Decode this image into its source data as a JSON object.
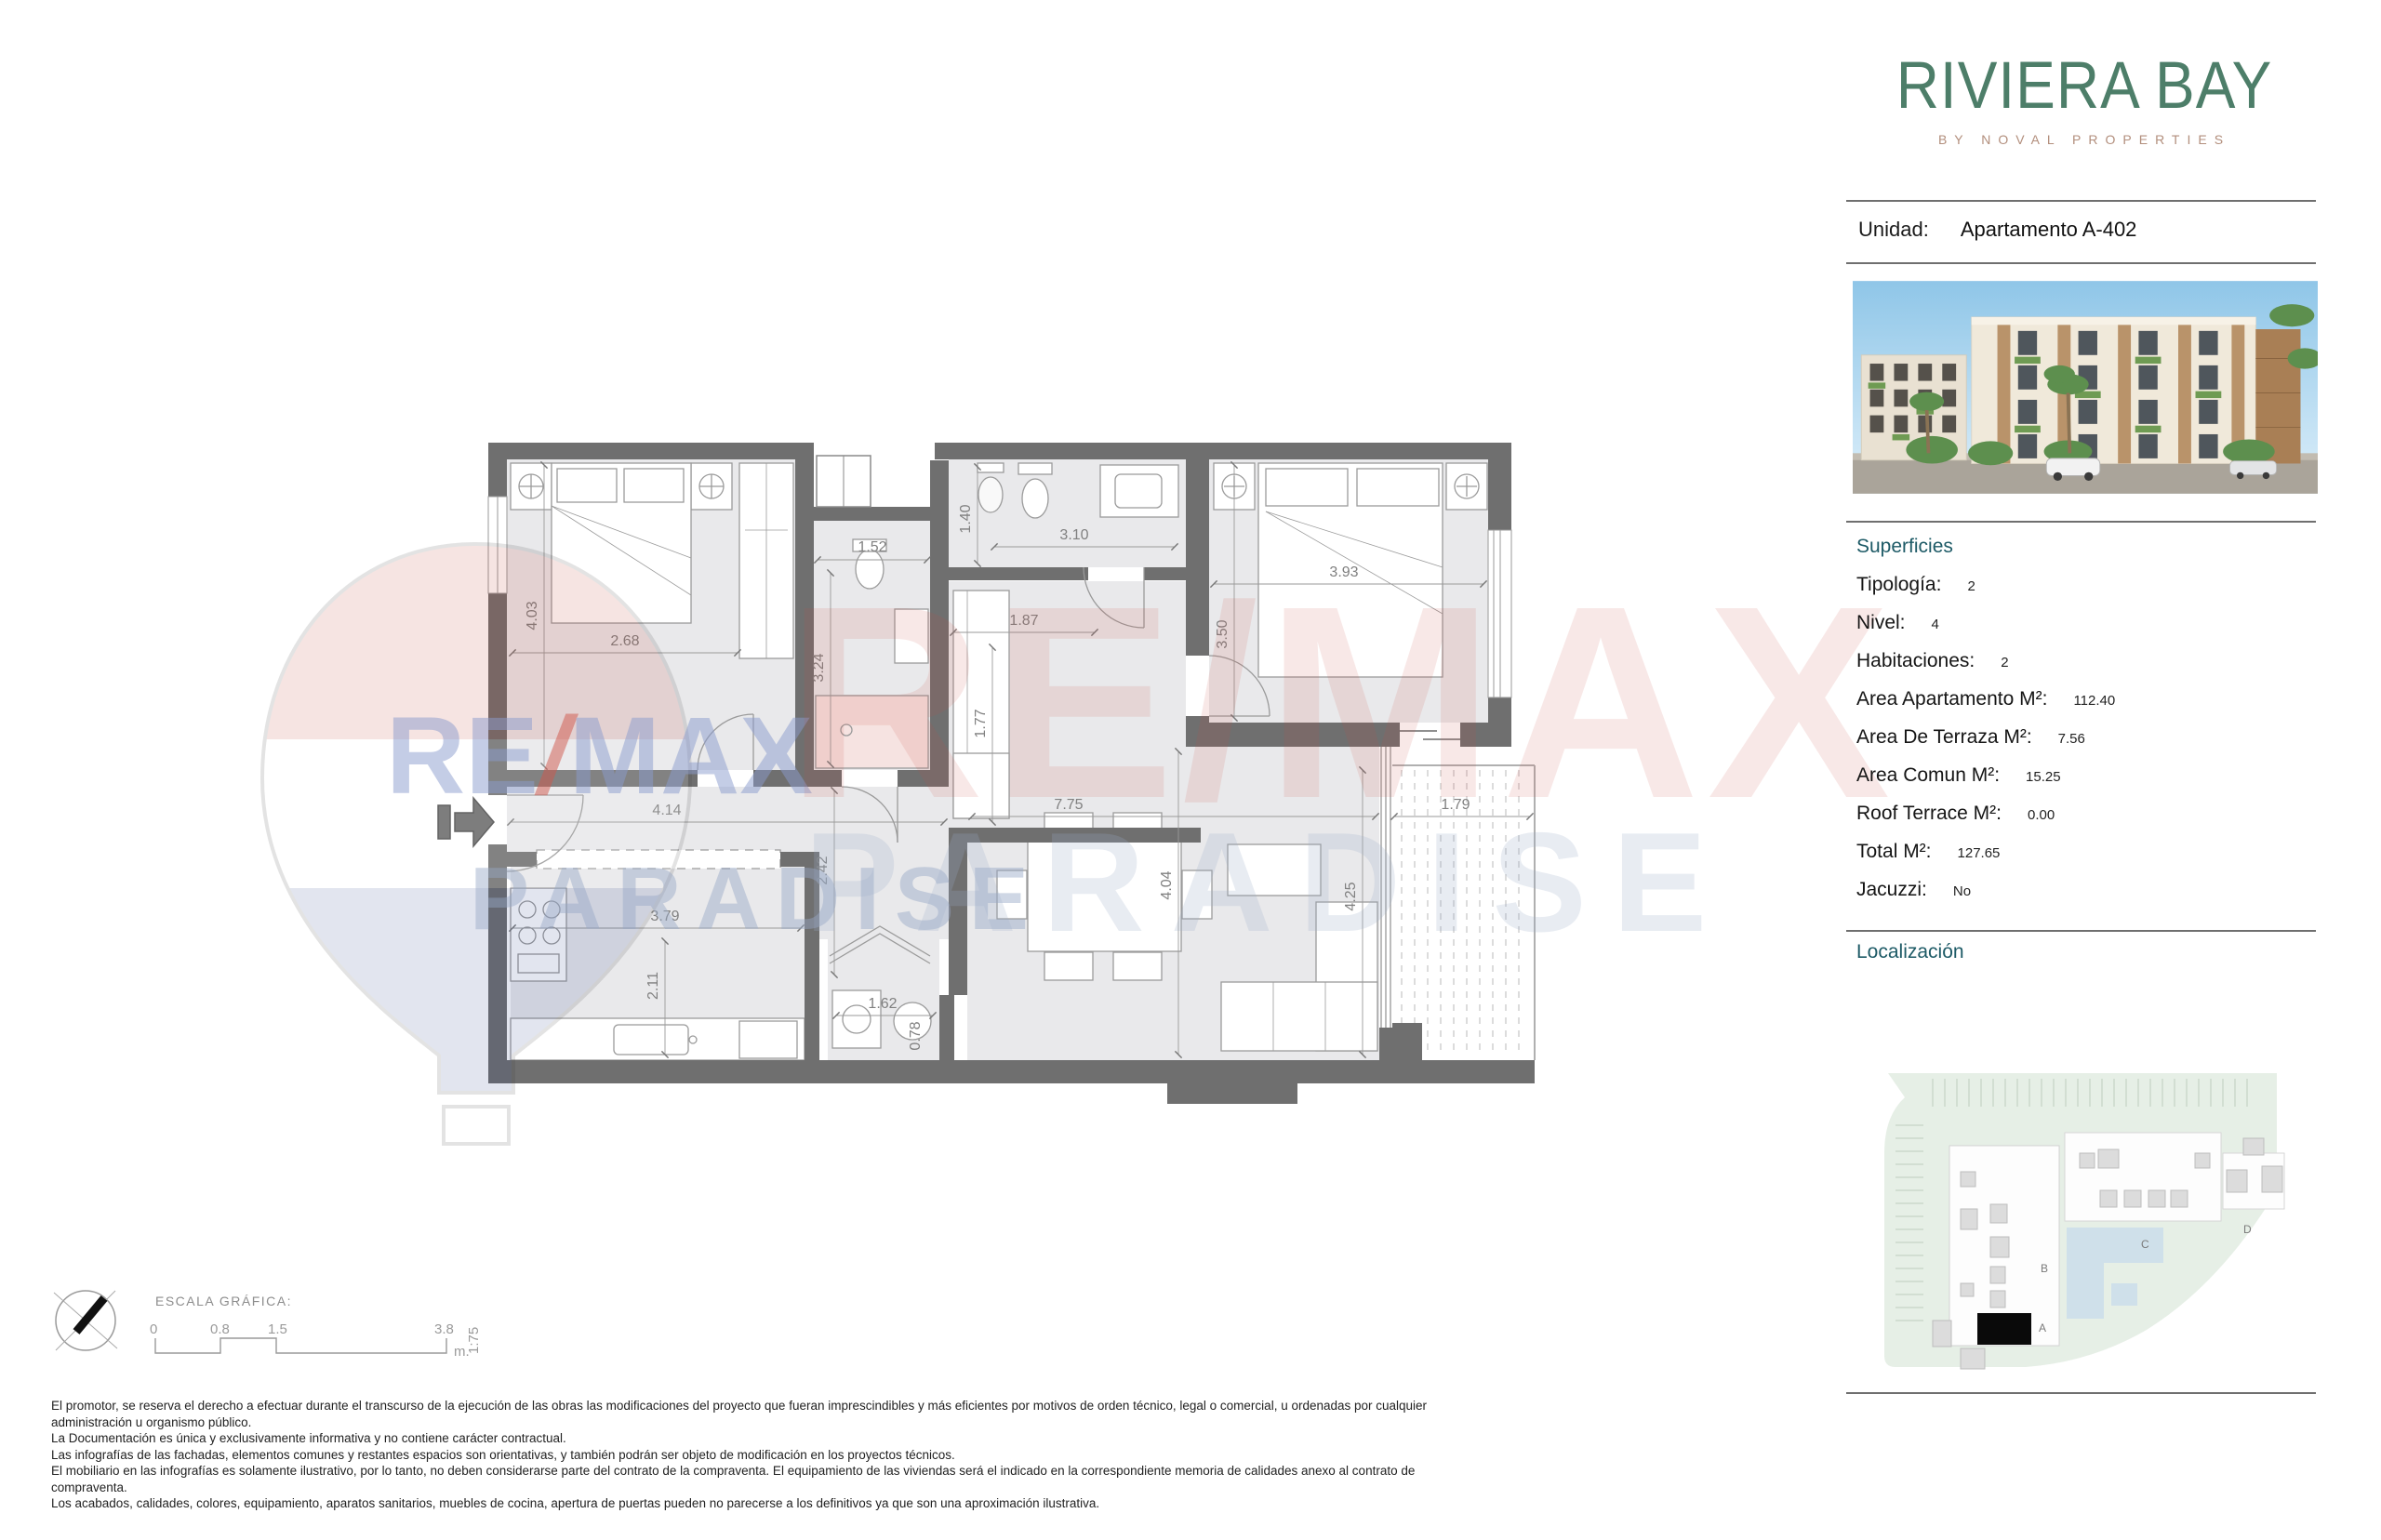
{
  "brand": {
    "title": "RIVIERA BAY",
    "tagline": "BY NOVAL PROPERTIES"
  },
  "unit": {
    "label": "Unidad:",
    "value": "Apartamento A-402"
  },
  "superficies": {
    "heading": "Superficies",
    "rows": [
      {
        "label": "Tipología:",
        "value": "2"
      },
      {
        "label": "Nivel:",
        "value": "4"
      },
      {
        "label": "Habitaciones:",
        "value": "2"
      },
      {
        "label": "Area Apartamento M²:",
        "value": "112.40"
      },
      {
        "label": "Area De Terraza M²:",
        "value": "7.56"
      },
      {
        "label": "Area Comun M²:",
        "value": "15.25"
      },
      {
        "label": "Roof Terrace M²:",
        "value": "0.00"
      },
      {
        "label": "Total M²:",
        "value": "127.65"
      },
      {
        "label": "Jacuzzi:",
        "value": "No"
      }
    ]
  },
  "localizacion": {
    "heading": "Localización",
    "blocks": [
      {
        "label": "A"
      },
      {
        "label": "B"
      },
      {
        "label": "C"
      },
      {
        "label": "D"
      }
    ]
  },
  "plan": {
    "dims": [
      {
        "text": "4.03"
      },
      {
        "text": "2.68"
      },
      {
        "text": "1.52"
      },
      {
        "text": "3.24"
      },
      {
        "text": "1.40"
      },
      {
        "text": "3.10"
      },
      {
        "text": "1.87"
      },
      {
        "text": "1.77"
      },
      {
        "text": "3.93"
      },
      {
        "text": "3.50"
      },
      {
        "text": "4.14"
      },
      {
        "text": "2.42"
      },
      {
        "text": "3.79"
      },
      {
        "text": "2.11"
      },
      {
        "text": "1.62"
      },
      {
        "text": "0.78"
      },
      {
        "text": "7.75"
      },
      {
        "text": "4.04"
      },
      {
        "text": "1.79"
      },
      {
        "text": "4.25"
      }
    ]
  },
  "watermark": {
    "re": "RE",
    "slash": "/",
    "max": "MAX",
    "paradise": "PARADISE"
  },
  "scale_bar": {
    "title": "ESCALA GRÁFICA:",
    "marks": [
      "0",
      "0.8",
      "1.5",
      "3.8"
    ],
    "unit": "m.",
    "ratio": "1:75"
  },
  "disclaimer": {
    "lines": [
      "El promotor, se reserva el derecho a efectuar durante el transcurso de la ejecución de las obras las modificaciones del proyecto que fueran imprescindibles y más eficientes por motivos de orden técnico, legal o comercial, u ordenadas por cualquier",
      "administración u organismo público.",
      "La Documentación es única y exclusivamente informativa y no contiene carácter contractual.",
      "Las infografías de las fachadas, elementos comunes y restantes espacios son orientativas, y también podrán ser objeto de modificación en los proyectos técnicos.",
      "El mobiliario en las infografías es solamente ilustrativo, por lo tanto, no deben considerarse parte del contrato de la compraventa. El equipamiento de las viviendas será el indicado en la correspondiente memoria de calidades anexo al contrato de",
      "compraventa.",
      "Los acabados, calidades, colores, equipamiento, aparatos sanitarios, muebles de cocina, apertura de puertas pueden no parecerse a los definitivos ya que son una aproximación ilustrativa."
    ]
  },
  "colors": {
    "brand_green": "#4d7e69",
    "tagline_tan": "#b28e7c",
    "heading_teal": "#1d5a66",
    "wall_gray": "#6f6f6f",
    "watermark_red": "#cc4a40",
    "watermark_blue": "#8b9cce"
  }
}
